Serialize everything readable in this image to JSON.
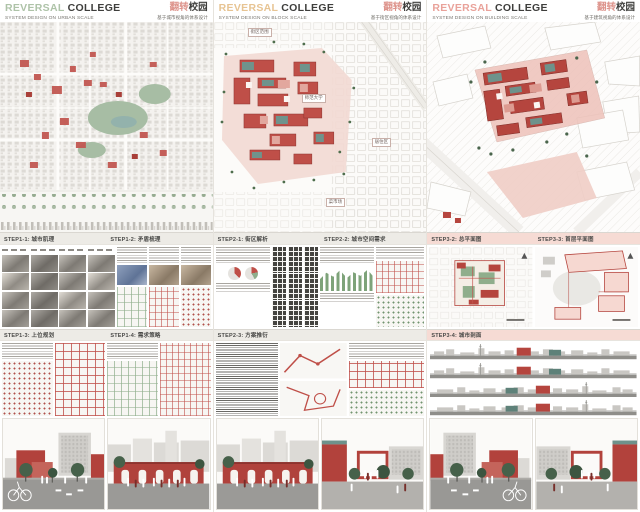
{
  "board": {
    "title": "REVERSAL COLLEGE 翻转校园",
    "panels": [
      {
        "id": "urban-scale",
        "header": {
          "title_accent": "REVERSAL",
          "title_rest": "COLLEGE",
          "subtitle": "SYSTEM DESIGN ON URBAN SCALE",
          "title_cn_accent": "翻转",
          "title_cn_rest": "校园",
          "subtitle_cn": "基于城市视角的体系设计"
        },
        "accent_color": "#aec3a8",
        "steps_row1": [
          {
            "label": "STEP1-1: 城市肌理"
          },
          {
            "label": "STEP1-2: 矛盾梳理"
          }
        ],
        "steps_row2": [
          {
            "label": "STEP1-3: 上位规划"
          },
          {
            "label": "STEP1-4: 需求策略"
          }
        ]
      },
      {
        "id": "block-scale",
        "header": {
          "title_accent": "REVERSAL",
          "title_rest": "COLLEGE",
          "subtitle": "SYSTEM DESIGN ON BLOCK SCALE",
          "title_cn_accent": "翻转",
          "title_cn_rest": "校园",
          "subtitle_cn": "基于街区视角的体系设计"
        },
        "accent_color": "#e7c493",
        "map_labels": [
          {
            "text": "街区范围"
          },
          {
            "text": "师范大学"
          },
          {
            "text": "菜市场"
          },
          {
            "text": "居住区"
          }
        ],
        "steps_row1": [
          {
            "label": "STEP2-1: 街区解析"
          },
          {
            "label": "STEP2-2: 城市空间需求"
          }
        ],
        "steps_row2": [
          {
            "label": "STEP2-3: 方案推衍"
          }
        ]
      },
      {
        "id": "building-scale",
        "header": {
          "title_accent": "REVERSAL",
          "title_rest": "COLLEGE",
          "subtitle": "SYSTEM DESIGN ON BUILDING SCALE",
          "title_cn_accent": "翻转",
          "title_cn_rest": "校园",
          "subtitle_cn": "基于建筑视角的体系设计"
        },
        "accent_color": "#e9a29a",
        "steps_row1": [
          {
            "label": "STEP3-2: 总平面图"
          },
          {
            "label": "STEP3-3: 首层平面图"
          }
        ],
        "steps_row2": [
          {
            "label": "STEP3-4: 城市剖面"
          }
        ]
      }
    ],
    "colors": {
      "campus_red": "#b2423c",
      "roof_teal": "#6f938c",
      "tree_green": "#46614a",
      "cn_title_pink": "#dd938b",
      "banner_pink": "#f6dbd4",
      "park_green": "#a7bda4"
    }
  }
}
